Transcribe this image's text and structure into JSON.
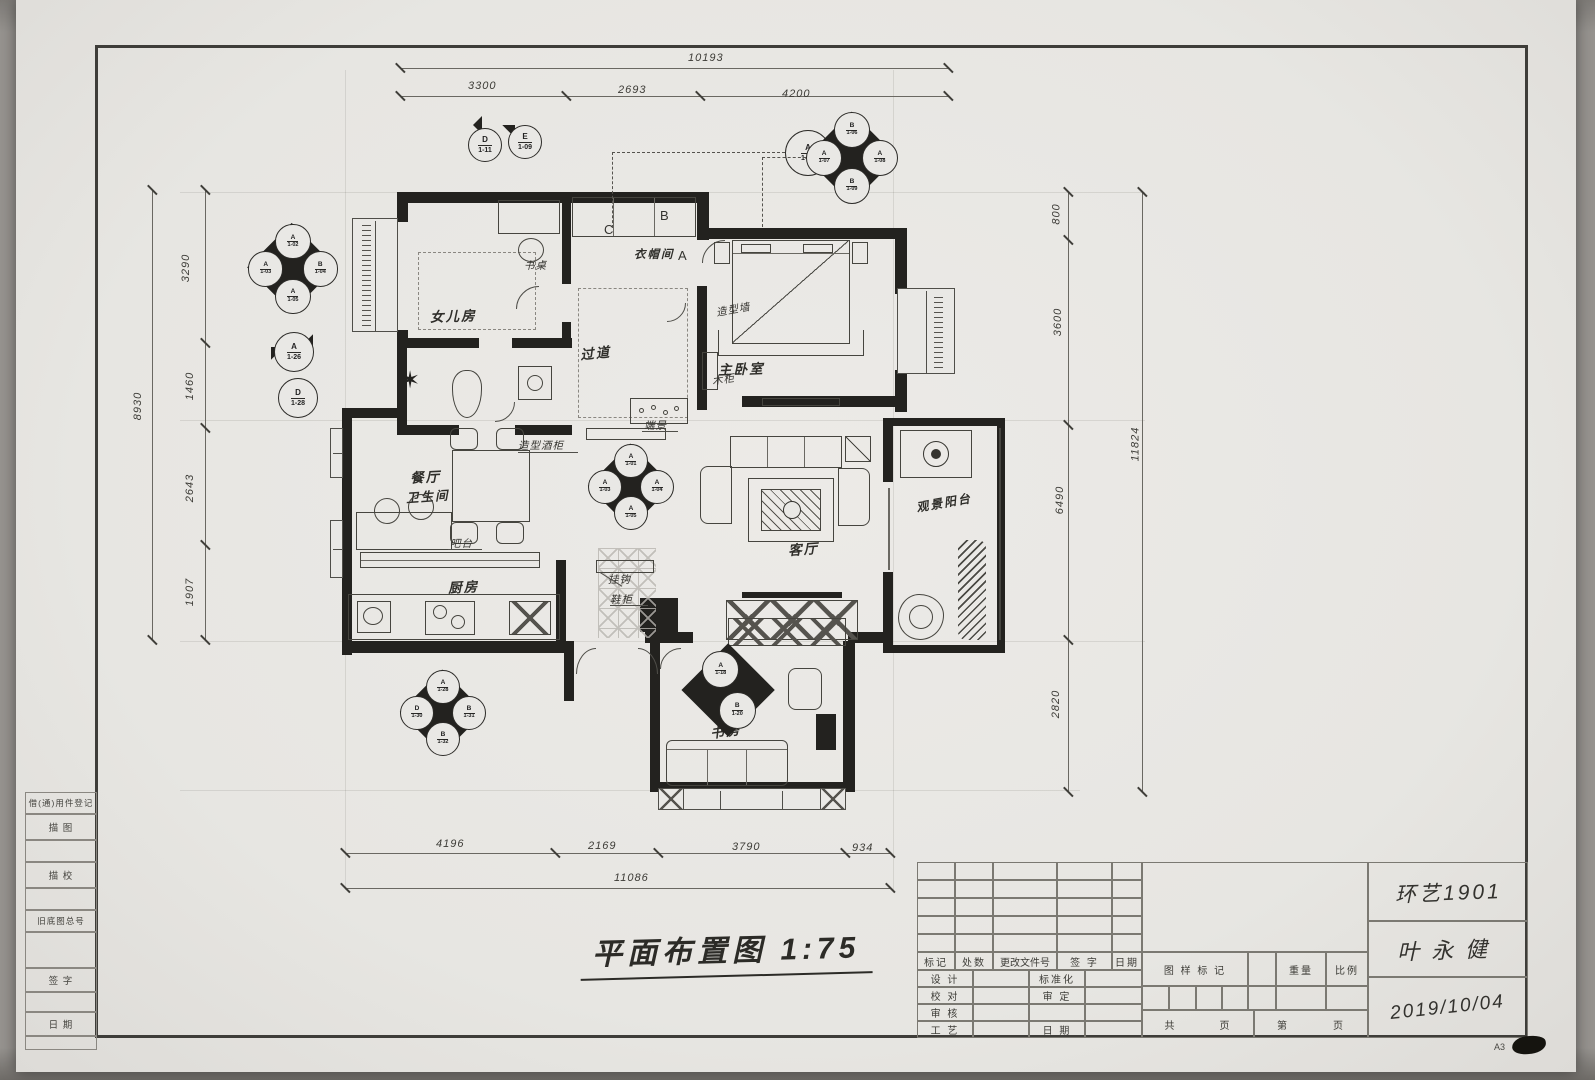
{
  "title": {
    "text": "平面布置图 1:75"
  },
  "rooms": {
    "daughter": "女儿房",
    "bath": "卫生间",
    "corridor": "过道",
    "cloak": "衣帽间",
    "master": "主卧室",
    "dining": "餐厅",
    "kitchen": "厨房",
    "living": "客厅",
    "balcony": "观景阳台",
    "study": "书房"
  },
  "annotations": {
    "desk": "书桌",
    "feature_wall": "造型墙",
    "wood_cabinet": "木柜",
    "wine_cabinet": "造型酒柜",
    "bar": "吧台",
    "endview": "端景",
    "hook": "挂钩",
    "shoe_cabinet": "鞋柜",
    "letter_a": "A",
    "letter_b": "B",
    "letter_c": "C",
    "star": "✶"
  },
  "dims": {
    "top": {
      "overall": "10193",
      "seg1": "3300",
      "seg2": "2693",
      "seg3": "4200"
    },
    "bottom": {
      "seg1": "4196",
      "seg2": "2169",
      "seg3": "3790",
      "seg4": "934",
      "overall": "11086"
    },
    "left": {
      "overall": "8930",
      "seg1": "3290",
      "seg2": "1460",
      "seg3": "2643",
      "seg4": "1907"
    },
    "right": {
      "seg1": "800",
      "seg2": "3600",
      "seg3": "6490",
      "seg4": "2820",
      "overall": "11824"
    }
  },
  "markers": {
    "m1": {
      "t": [
        "A",
        "1-02"
      ],
      "l": [
        "A",
        "1-03"
      ],
      "r": [
        "B",
        "1-04"
      ],
      "b": [
        "A",
        "1-05"
      ]
    },
    "m2": {
      "a": [
        "D",
        "1-11"
      ],
      "b": [
        "E",
        "1-09"
      ]
    },
    "m3": [
      "A",
      "1-07"
    ],
    "m4": {
      "t": [
        "B",
        "1-06"
      ],
      "l": [
        "A",
        "1-07"
      ],
      "r": [
        "A",
        "1-08"
      ],
      "b": [
        "B",
        "1-09"
      ]
    },
    "m5": [
      "A",
      "1-26"
    ],
    "m6": [
      "D",
      "1-28"
    ],
    "m7": {
      "t": [
        "A",
        "1-01"
      ],
      "l": [
        "A",
        "1-03"
      ],
      "r": [
        "A",
        "1-04"
      ],
      "b": [
        "A",
        "1-05"
      ]
    },
    "m8": {
      "t": [
        "A",
        "1-28"
      ],
      "l": [
        "D",
        "1-30"
      ],
      "r": [
        "B",
        "1-31"
      ],
      "b": [
        "B",
        "1-32"
      ]
    },
    "m9": {
      "t": [
        "A",
        "1-18"
      ],
      "b": [
        "B",
        "1-20"
      ]
    }
  },
  "titleblock": {
    "left_strip": [
      "借(通)用件登记",
      "描 图",
      "描 校",
      "旧底图总号",
      "签 字",
      "日 期"
    ],
    "rev_headers": [
      "标记",
      "处数",
      "更改文件号",
      "签 字",
      "日期"
    ],
    "roles": {
      "design": "设 计",
      "standard": "标准化",
      "proof": "校 对",
      "approve": "审 定",
      "audit": "审 核",
      "craft": "工 艺",
      "date": "日 期"
    },
    "right": {
      "mark": "图 样 标 记",
      "weight": "重量",
      "scale": "比例",
      "total": "共",
      "page_char": "页",
      "no": "第",
      "page_char2": "页"
    },
    "entries": {
      "class_name": "环艺1901",
      "student": "叶永健",
      "date": "2019/10/04"
    },
    "sheet_size": "A3"
  }
}
